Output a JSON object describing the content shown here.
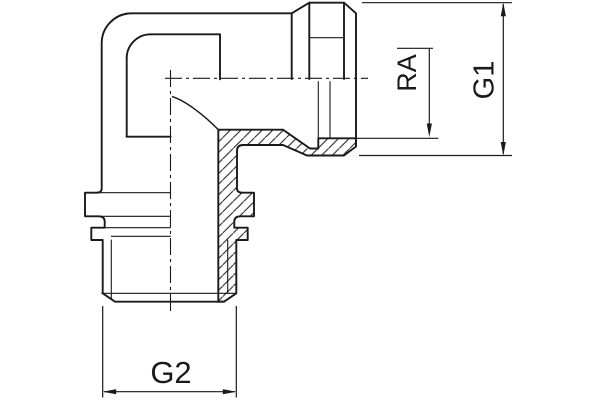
{
  "drawing": {
    "title": "elbow-fitting-section-view"
  },
  "dimensions": {
    "ra": {
      "label": "RA"
    },
    "g1": {
      "label": "G1"
    },
    "g2": {
      "label": "G2"
    }
  },
  "colors": {
    "line": "#1a1a1a",
    "background": "#ffffff"
  }
}
